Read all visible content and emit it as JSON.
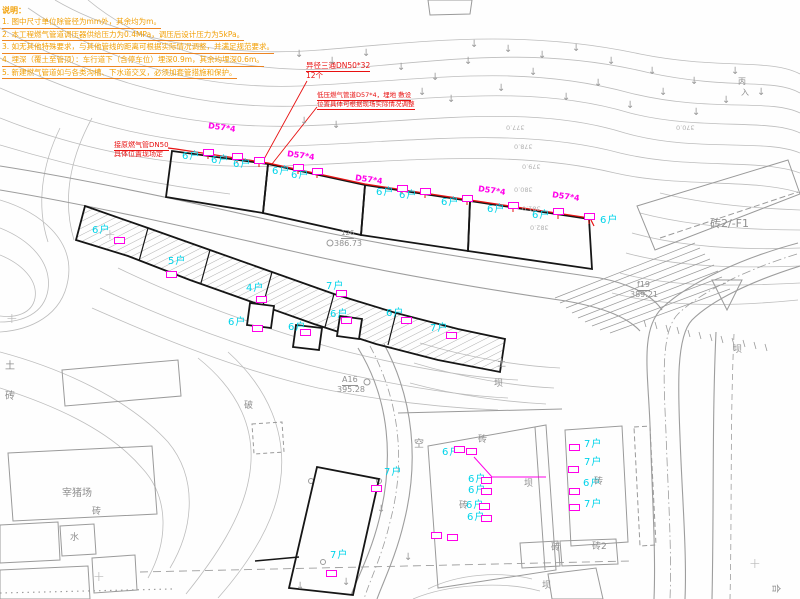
{
  "notes": {
    "title": "说明：",
    "lines": [
      {
        "t": "1. 图中尺寸单位除管径为mm外，其余均为m。"
      },
      {
        "t": "2. 本工程燃气管道调压器供给压力为0.4MPa，调压后设计压力为5kPa。"
      },
      {
        "t": "3. 如无其他特殊要求，与其他管线的距离可根据实际情况调整，并满足规范要求。"
      },
      {
        "t": "4. 埋深（覆土至管顶）：车行道下（含停车位）埋深0.9m，其余均埋深0.6m。"
      },
      {
        "t": "5. 新建燃气管道如与各类沟槽、下水道交叉，必须加套管措施和保护。"
      }
    ]
  },
  "red_annotations": [
    {
      "t": "异径三通DN50*32",
      "x": 306,
      "y": 62,
      "fs": 7.5,
      "u": true
    },
    {
      "t": "12个",
      "x": 306,
      "y": 72,
      "fs": 7.5
    },
    {
      "t": "低压燃气管道D57*4，埋地 敷设",
      "x": 317,
      "y": 92,
      "fs": 6.5,
      "u": true
    },
    {
      "t": "位置具体可根据现场实际情况调整",
      "x": 317,
      "y": 101,
      "fs": 6.5,
      "u": true
    },
    {
      "t": "接原燃气管DN50",
      "x": 114,
      "y": 142,
      "fs": 7,
      "u": true
    },
    {
      "t": "具体位置现场定",
      "x": 114,
      "y": 151,
      "fs": 7
    }
  ],
  "pipe_size_labels": [
    {
      "t": "D57*4",
      "x": 208,
      "y": 124,
      "rot": 8
    },
    {
      "t": "D57*4",
      "x": 287,
      "y": 152,
      "rot": 8
    },
    {
      "t": "D57*4",
      "x": 355,
      "y": 176,
      "rot": 8
    },
    {
      "t": "D57*4",
      "x": 478,
      "y": 187,
      "rot": 8
    },
    {
      "t": "D57*4",
      "x": 552,
      "y": 193,
      "rot": 8
    }
  ],
  "household_labels": [
    {
      "t": "6户",
      "x": 182,
      "y": 152
    },
    {
      "t": "6户",
      "x": 211,
      "y": 156
    },
    {
      "t": "6户",
      "x": 233,
      "y": 160
    },
    {
      "t": "6户",
      "x": 272,
      "y": 167
    },
    {
      "t": "6户",
      "x": 291,
      "y": 171
    },
    {
      "t": "6户",
      "x": 376,
      "y": 188
    },
    {
      "t": "6户",
      "x": 399,
      "y": 191
    },
    {
      "t": "6户",
      "x": 441,
      "y": 198
    },
    {
      "t": "6户",
      "x": 487,
      "y": 205
    },
    {
      "t": "6户",
      "x": 532,
      "y": 211
    },
    {
      "t": "6户",
      "x": 600,
      "y": 216
    },
    {
      "t": "6户",
      "x": 92,
      "y": 226
    },
    {
      "t": "5户",
      "x": 168,
      "y": 257
    },
    {
      "t": "4户",
      "x": 246,
      "y": 284
    },
    {
      "t": "7户",
      "x": 326,
      "y": 282
    },
    {
      "t": "6户",
      "x": 228,
      "y": 318
    },
    {
      "t": "6户",
      "x": 288,
      "y": 323
    },
    {
      "t": "6户",
      "x": 330,
      "y": 310
    },
    {
      "t": "6户",
      "x": 386,
      "y": 309
    },
    {
      "t": "7户",
      "x": 430,
      "y": 324
    },
    {
      "t": "6户",
      "x": 442,
      "y": 448
    },
    {
      "t": "6户",
      "x": 468,
      "y": 475
    },
    {
      "t": "6户",
      "x": 468,
      "y": 486
    },
    {
      "t": "6户",
      "x": 466,
      "y": 501
    },
    {
      "t": "6户",
      "x": 467,
      "y": 513
    },
    {
      "t": "7户",
      "x": 584,
      "y": 440
    },
    {
      "t": "7户",
      "x": 584,
      "y": 458
    },
    {
      "t": "6户",
      "x": 583,
      "y": 479
    },
    {
      "t": "7户",
      "x": 584,
      "y": 500
    },
    {
      "t": "7户",
      "x": 384,
      "y": 468
    },
    {
      "t": "7户",
      "x": 330,
      "y": 551
    }
  ],
  "gray_labels": [
    {
      "t": "砖2/-F1",
      "x": 710,
      "y": 218,
      "fs": 11
    },
    {
      "t": "f19",
      "x": 637,
      "y": 281,
      "fs": 8,
      "u": true
    },
    {
      "t": "389.21",
      "x": 630,
      "y": 291,
      "fs": 8
    },
    {
      "t": "126",
      "x": 341,
      "y": 230,
      "fs": 7,
      "u": true
    },
    {
      "t": "386.73",
      "x": 334,
      "y": 240,
      "fs": 8
    },
    {
      "t": "A16",
      "x": 342,
      "y": 376,
      "fs": 8,
      "u": true
    },
    {
      "t": "395.28",
      "x": 337,
      "y": 386,
      "fs": 8
    },
    {
      "t": "土",
      "x": 5,
      "y": 362,
      "fs": 10
    },
    {
      "t": "砖",
      "x": 5,
      "y": 392,
      "fs": 10
    },
    {
      "t": "宰猪场",
      "x": 62,
      "y": 489,
      "fs": 10
    },
    {
      "t": "砖",
      "x": 92,
      "y": 508,
      "fs": 9
    },
    {
      "t": "水",
      "x": 70,
      "y": 534,
      "fs": 9
    },
    {
      "t": "破",
      "x": 244,
      "y": 402,
      "fs": 9
    },
    {
      "t": "空",
      "x": 414,
      "y": 440,
      "fs": 10
    },
    {
      "t": "土",
      "x": 497,
      "y": 360,
      "fs": 9
    },
    {
      "t": "坝",
      "x": 494,
      "y": 380,
      "fs": 9
    },
    {
      "t": "坝",
      "x": 733,
      "y": 346,
      "fs": 9
    },
    {
      "t": "砖",
      "x": 478,
      "y": 436,
      "fs": 9
    },
    {
      "t": "坝",
      "x": 524,
      "y": 480,
      "fs": 9
    },
    {
      "t": "砖",
      "x": 459,
      "y": 502,
      "fs": 9
    },
    {
      "t": "砖",
      "x": 594,
      "y": 478,
      "fs": 9
    },
    {
      "t": "砖",
      "x": 551,
      "y": 544,
      "fs": 9
    },
    {
      "t": "砖2",
      "x": 592,
      "y": 543,
      "fs": 9
    },
    {
      "t": "坝",
      "x": 542,
      "y": 582,
      "fs": 9
    },
    {
      "t": "丙",
      "x": 738,
      "y": 78,
      "fs": 8
    },
    {
      "t": "入",
      "x": 741,
      "y": 89,
      "fs": 8
    },
    {
      "t": "合",
      "x": 770,
      "y": 584,
      "fs": 9,
      "rot": 90
    },
    {
      "t": "377.0",
      "x": 506,
      "y": 124,
      "fs": 6.5,
      "rot": 180,
      "faint": true
    },
    {
      "t": "378.0",
      "x": 514,
      "y": 143,
      "fs": 6.5,
      "rot": 180,
      "faint": true
    },
    {
      "t": "379.0",
      "x": 522,
      "y": 163,
      "fs": 6.5,
      "rot": 180,
      "faint": true
    },
    {
      "t": "380.0",
      "x": 514,
      "y": 186,
      "fs": 6.5,
      "rot": 180,
      "faint": true
    },
    {
      "t": "381.0",
      "x": 522,
      "y": 205,
      "fs": 6.5,
      "rot": 180,
      "faint": true
    },
    {
      "t": "382.0",
      "x": 530,
      "y": 224,
      "fs": 6.5,
      "rot": 180,
      "faint": true
    },
    {
      "t": "370.0",
      "x": 676,
      "y": 124,
      "fs": 6.5,
      "rot": 180,
      "faint": true
    }
  ],
  "regulator_boxes": {
    "points": [
      {
        "x": 203,
        "y": 149
      },
      {
        "x": 232,
        "y": 153
      },
      {
        "x": 254,
        "y": 157
      },
      {
        "x": 293,
        "y": 164
      },
      {
        "x": 312,
        "y": 168
      },
      {
        "x": 397,
        "y": 185
      },
      {
        "x": 420,
        "y": 188
      },
      {
        "x": 462,
        "y": 195
      },
      {
        "x": 508,
        "y": 202
      },
      {
        "x": 553,
        "y": 208
      },
      {
        "x": 584,
        "y": 213
      },
      {
        "x": 114,
        "y": 237
      },
      {
        "x": 166,
        "y": 271
      },
      {
        "x": 256,
        "y": 296
      },
      {
        "x": 336,
        "y": 290
      },
      {
        "x": 252,
        "y": 325
      },
      {
        "x": 300,
        "y": 329
      },
      {
        "x": 341,
        "y": 317
      },
      {
        "x": 401,
        "y": 317
      },
      {
        "x": 446,
        "y": 332
      },
      {
        "x": 454,
        "y": 446
      },
      {
        "x": 466,
        "y": 448
      },
      {
        "x": 481,
        "y": 477
      },
      {
        "x": 481,
        "y": 488
      },
      {
        "x": 479,
        "y": 503
      },
      {
        "x": 481,
        "y": 515
      },
      {
        "x": 431,
        "y": 532
      },
      {
        "x": 447,
        "y": 534
      },
      {
        "x": 569,
        "y": 444
      },
      {
        "x": 568,
        "y": 466
      },
      {
        "x": 569,
        "y": 488
      },
      {
        "x": 569,
        "y": 504
      },
      {
        "x": 371,
        "y": 485
      },
      {
        "x": 326,
        "y": 570
      }
    ]
  },
  "slope_arrows": {
    "glyph": "↓",
    "points": [
      {
        "x": 295,
        "y": 50
      },
      {
        "x": 328,
        "y": 57
      },
      {
        "x": 362,
        "y": 49
      },
      {
        "x": 397,
        "y": 63
      },
      {
        "x": 431,
        "y": 73
      },
      {
        "x": 464,
        "y": 57
      },
      {
        "x": 497,
        "y": 84
      },
      {
        "x": 529,
        "y": 68
      },
      {
        "x": 562,
        "y": 93
      },
      {
        "x": 594,
        "y": 79
      },
      {
        "x": 626,
        "y": 101
      },
      {
        "x": 659,
        "y": 88
      },
      {
        "x": 692,
        "y": 108
      },
      {
        "x": 722,
        "y": 96
      },
      {
        "x": 470,
        "y": 40
      },
      {
        "x": 504,
        "y": 45
      },
      {
        "x": 538,
        "y": 51
      },
      {
        "x": 572,
        "y": 44
      },
      {
        "x": 607,
        "y": 57
      },
      {
        "x": 648,
        "y": 67
      },
      {
        "x": 690,
        "y": 77
      },
      {
        "x": 731,
        "y": 67
      },
      {
        "x": 757,
        "y": 88
      },
      {
        "x": 300,
        "y": 117
      },
      {
        "x": 332,
        "y": 121
      },
      {
        "x": 418,
        "y": 88
      },
      {
        "x": 447,
        "y": 95
      },
      {
        "x": 377,
        "y": 505
      },
      {
        "x": 404,
        "y": 553
      },
      {
        "x": 342,
        "y": 578
      },
      {
        "x": 296,
        "y": 582
      }
    ]
  },
  "crosses": {
    "glyph": "+",
    "points": [
      {
        "x": 104,
        "y": 228
      },
      {
        "x": 93,
        "y": 570
      },
      {
        "x": 749,
        "y": 557
      },
      {
        "x": 6,
        "y": 312
      }
    ]
  },
  "colors": {
    "pipe_red": "#e81212",
    "meter_magenta": "#ff00e8",
    "household_cyan": "#00d4ea",
    "notes_orange": "#f2a007",
    "linework_gray": "#9a9a9a"
  }
}
